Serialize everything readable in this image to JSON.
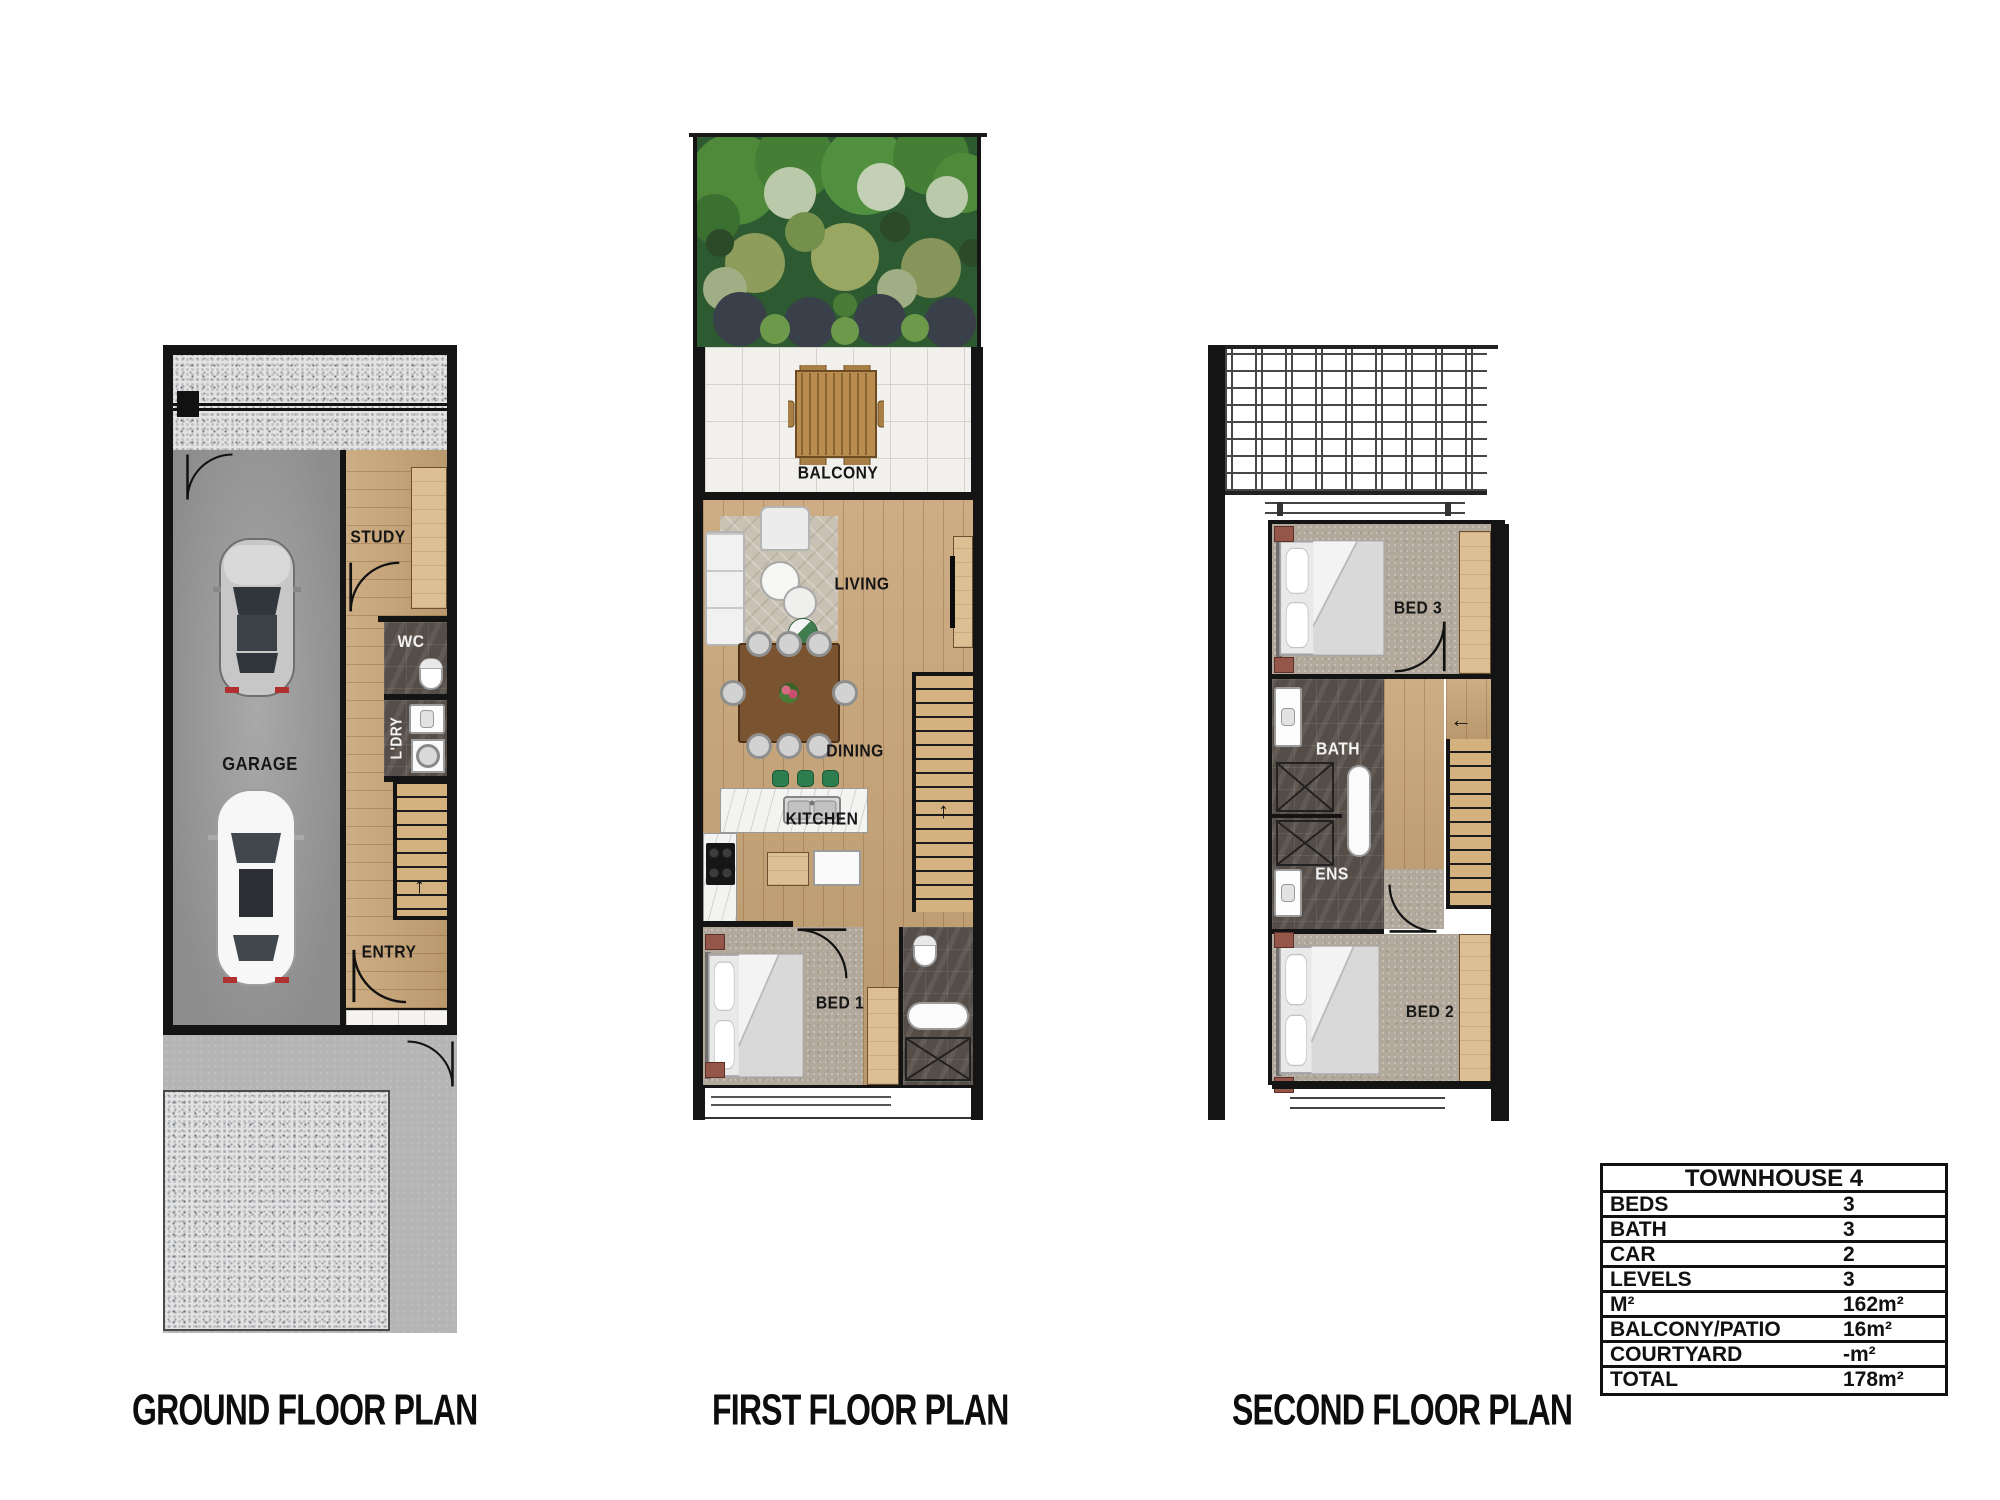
{
  "titles": {
    "ground": "GROUND FLOOR PLAN",
    "first": "FIRST FLOOR PLAN",
    "second": "SECOND FLOOR PLAN"
  },
  "rooms": {
    "ground": {
      "study": "STUDY",
      "wc": "WC",
      "ldry": "L'DRY",
      "garage": "GARAGE",
      "entry": "ENTRY"
    },
    "first": {
      "balcony": "BALCONY",
      "living": "LIVING",
      "dining": "DINING",
      "kitchen": "KITCHEN",
      "bed1": "BED 1"
    },
    "second": {
      "bed3": "BED 3",
      "bath": "BATH",
      "ens": "ENS",
      "bed2": "BED 2"
    }
  },
  "stairs": {
    "up_arrow": "↑",
    "left_arrow": "←"
  },
  "table": {
    "title": "TOWNHOUSE 4",
    "rows": [
      {
        "label": "BEDS",
        "value": "3"
      },
      {
        "label": "BATH",
        "value": "3"
      },
      {
        "label": "CAR",
        "value": "2"
      },
      {
        "label": "LEVELS",
        "value": "3"
      },
      {
        "label": "M²",
        "value": "162m²"
      },
      {
        "label": "BALCONY/PATIO",
        "value": "16m²"
      },
      {
        "label": "COURTYARD",
        "value": "-m²"
      },
      {
        "label": "TOTAL",
        "value": "178m²"
      }
    ]
  },
  "colors": {
    "wall": "#141414",
    "woodFloor": "#c8a476",
    "woodLight": "#dcc093",
    "carpet": "#b2a99c",
    "darkTile": "#554e48",
    "balconyTile": "#f1f0ec",
    "gravel": "#e3e3e3",
    "concrete": "#b5b5b5",
    "gardenGreen": "#2d5a30",
    "accentGreen": "#2e7d4f",
    "tableBrown": "#7a5330",
    "sideTable": "#95564a"
  }
}
